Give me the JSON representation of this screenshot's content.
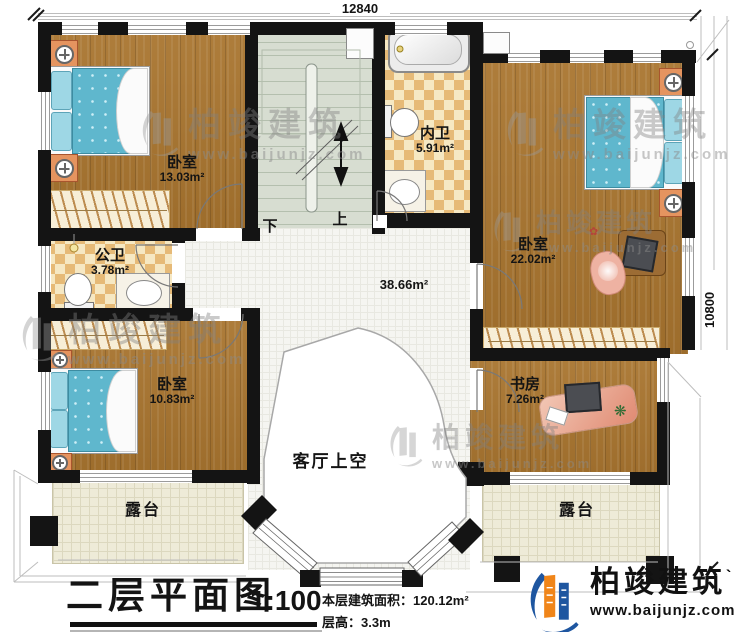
{
  "dimensions": {
    "top": "12840",
    "right": "10800"
  },
  "rooms": {
    "bedroom_top_left": {
      "label": "卧室",
      "area": "13.03m²"
    },
    "inner_bath": {
      "label": "内卫",
      "area": "5.91m²"
    },
    "bedroom_right": {
      "label": "卧室",
      "area": "22.02m²"
    },
    "public_bath": {
      "label": "公卫",
      "area": "3.78m²"
    },
    "hall": {
      "area": "38.66m²"
    },
    "bedroom_bottom_left": {
      "label": "卧室",
      "area": "10.83m²"
    },
    "study": {
      "label": "书房",
      "area": "7.26m²"
    },
    "living_room_void": {
      "label": "客厅上空"
    },
    "terrace_left": {
      "label": "露台"
    },
    "terrace_right": {
      "label": "露台"
    }
  },
  "stairs": {
    "down_label": "下",
    "up_label": "上"
  },
  "watermark": {
    "brand": "柏竣建筑",
    "url": "www.baijunjz.com"
  },
  "logo": {
    "brand": "柏竣建筑",
    "mark": "`",
    "url": "www.baijunjz.com"
  },
  "title_block": {
    "title": "二层平面图",
    "scale": "1:100",
    "area_text": "本层建筑面积：120.12m²",
    "floor_height_text": "层高：3.3m"
  },
  "colors": {
    "wall": "#141414",
    "wood_floor": "#a9752f",
    "bath_checker": "#e6ba77",
    "stair": "#d7ddd1",
    "terrace": "#eeebd8",
    "bed_blue": "#5fb7cd",
    "logo_blue": "#1e56a0",
    "logo_orange": "#f08519"
  }
}
